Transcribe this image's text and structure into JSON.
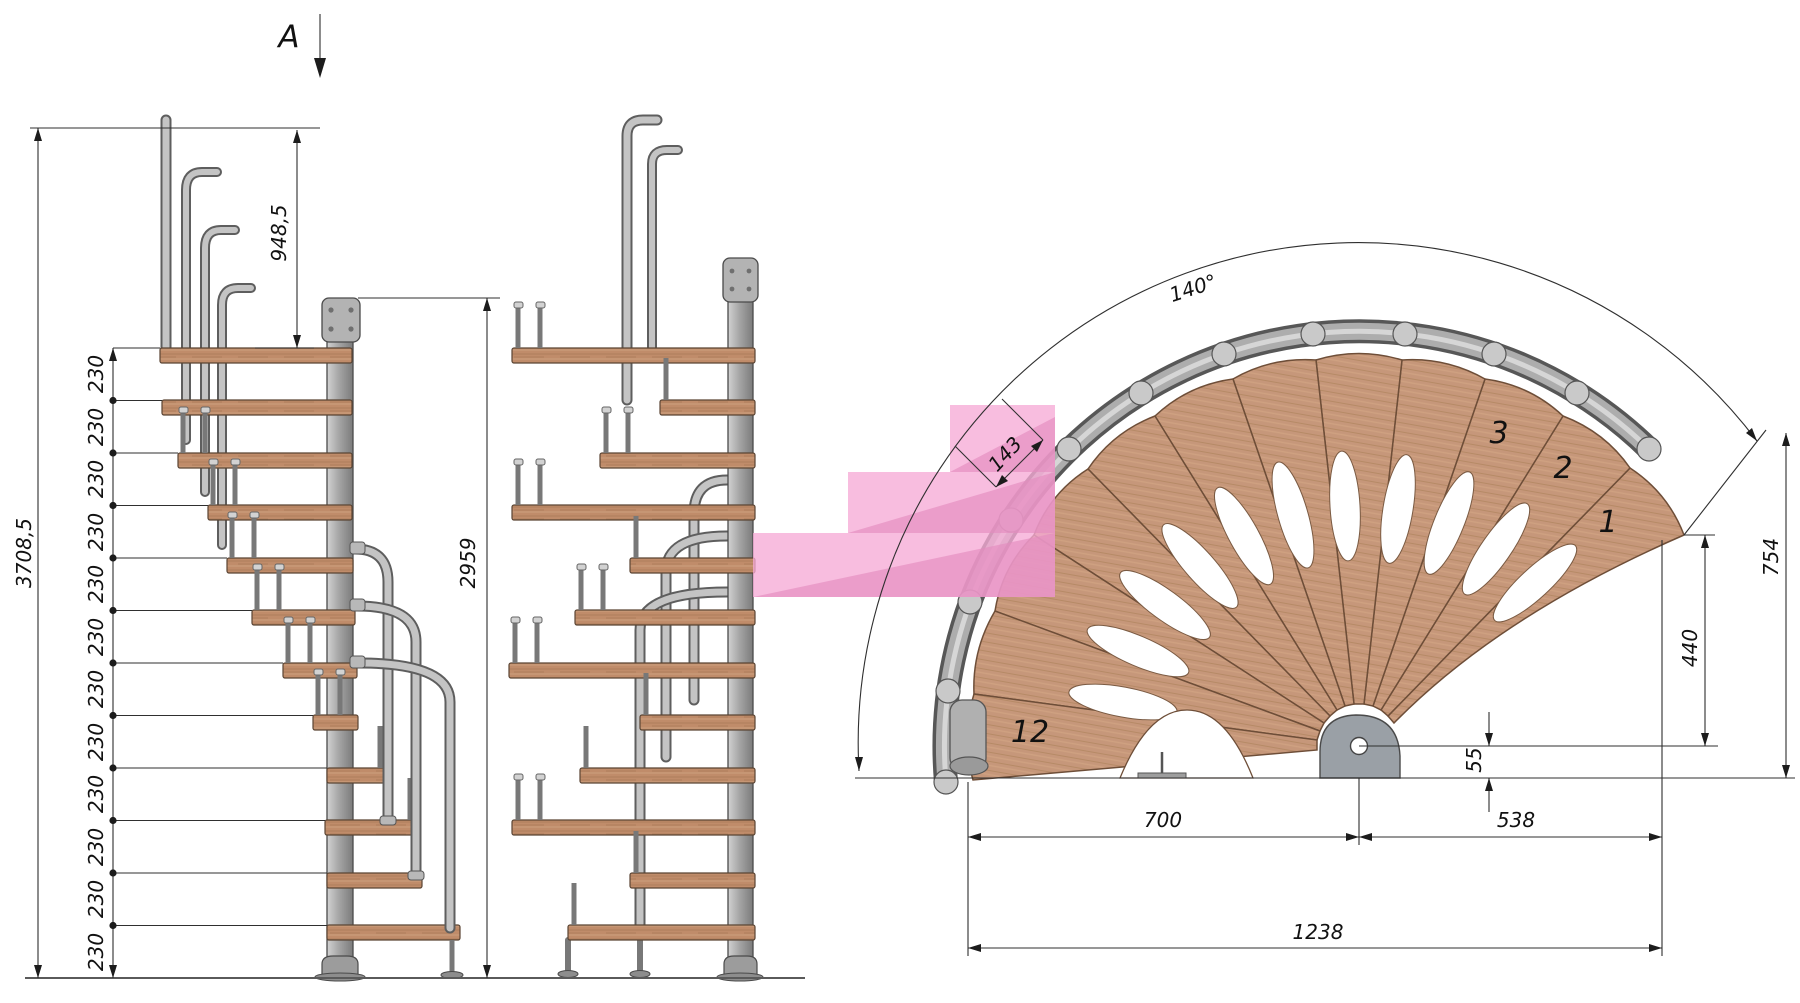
{
  "drawing": {
    "section_label": "A",
    "side_view": {
      "overall_height": "3708,5",
      "top_height": "948,5",
      "risers": [
        "230",
        "230",
        "230",
        "230",
        "230",
        "230",
        "230",
        "230",
        "230",
        "230",
        "230",
        "230"
      ]
    },
    "front_view": {
      "pole_height": "2959"
    },
    "plan_view": {
      "rotation_angle": "140°",
      "tread_width": "143",
      "outer_radius": "754",
      "inner_radius": "440",
      "center_offset": "55",
      "width_left": "700",
      "width_right": "538",
      "width_total": "1238",
      "tread_first": "1",
      "tread_second": "2",
      "tread_third": "3",
      "tread_last": "12"
    },
    "colors": {
      "wood": "#c6977a",
      "wood_edge": "#6e4e38",
      "metal": "#a9a9a9",
      "metal_edge": "#565656",
      "highlight_pink": "#f5b0d8",
      "highlight_pink_dark": "#e391c0",
      "dimension_line": "#2f2f2f",
      "text": "#111111"
    }
  }
}
